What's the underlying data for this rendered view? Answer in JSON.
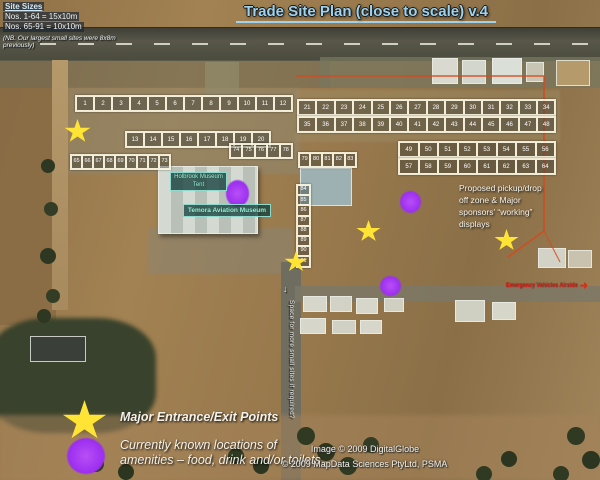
{
  "header": {
    "title": "Trade Site Plan (close to scale) v.4"
  },
  "site_sizes": {
    "heading": "Site Sizes",
    "line1": "Nos. 1-64 = 15x10m",
    "line2": "Nos. 65-91 = 10x10m",
    "note": "(NB. Our largest small sites were 8x8m previously)"
  },
  "sites": {
    "groups": [
      {
        "id": "g1",
        "numbers": [
          "1",
          "2",
          "3",
          "4",
          "5",
          "6",
          "7",
          "8",
          "9",
          "10",
          "11",
          "12"
        ]
      },
      {
        "id": "g2",
        "numbers": [
          "13",
          "14",
          "15",
          "16",
          "17",
          "18",
          "19",
          "20"
        ]
      },
      {
        "id": "g3",
        "numbers": [
          "21",
          "22",
          "23",
          "24",
          "25",
          "26",
          "27",
          "28",
          "29",
          "30",
          "31",
          "32",
          "33",
          "34"
        ]
      },
      {
        "id": "g4",
        "numbers": [
          "35",
          "36",
          "37",
          "38",
          "39",
          "40",
          "41",
          "42",
          "43",
          "44",
          "45",
          "46",
          "47",
          "48"
        ]
      },
      {
        "id": "g5",
        "numbers": [
          "49",
          "50",
          "51",
          "52",
          "53",
          "54",
          "55",
          "56"
        ]
      },
      {
        "id": "g6",
        "numbers": [
          "57",
          "58",
          "59",
          "60",
          "61",
          "62",
          "63",
          "64"
        ]
      },
      {
        "id": "g7",
        "numbers": [
          "65",
          "66",
          "67",
          "68",
          "69",
          "70",
          "71",
          "72",
          "73"
        ]
      },
      {
        "id": "g8",
        "numbers": [
          "74",
          "75",
          "76",
          "77",
          "78"
        ]
      },
      {
        "id": "g9",
        "numbers": [
          "79",
          "80",
          "81",
          "82",
          "83"
        ]
      },
      {
        "id": "g10",
        "numbers": [
          "84",
          "85",
          "86",
          "87",
          "88",
          "89",
          "90",
          "91"
        ]
      }
    ]
  },
  "labels": {
    "museum_tent": "Holbrook Museum Tent",
    "museum_main": "Temora Aviation Museum",
    "proposed_zone": "Proposed pickup/drop off zone & Major sponsors’ “working” displays",
    "space_note": "Space for more small sites if required?",
    "space_arrow": "↓",
    "airside_note": "Emergency Vehicles Airside",
    "airside_arrow": "➜"
  },
  "legend": {
    "entrance_label": "Major Entrance/Exit Points",
    "amenities_label": "Currently known locations of amenities – food, drink and/or toilets"
  },
  "credits": {
    "line1": "Image © 2009 DigitalGlobe",
    "line2": "© 2009 MapData Sciences PtyLtd, PSMA"
  },
  "colors": {
    "title_text": "#9ed3ef",
    "entrance_star": "#ffe335",
    "amenity_marker": "#a636f2",
    "route_line": "#d6491d",
    "site_box_border": "#f2ead6"
  }
}
